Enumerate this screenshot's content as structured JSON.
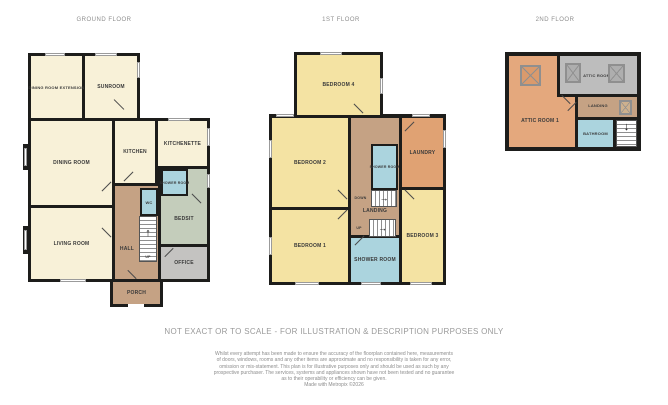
{
  "palette": {
    "wall": "#1d1d1b",
    "cream": "#f8f1d8",
    "yellow": "#f4e3a3",
    "tan": "#c5a284",
    "blue": "#abd4de",
    "sage": "#c4cdbb",
    "gray": "#c4c3c1",
    "orange": "#e0a273",
    "attic_orange": "#e4a87d",
    "attic_gray": "#bdbdbd",
    "label": "#3a3a3a",
    "title": "#8e8e8e"
  },
  "floors": {
    "ground": {
      "title": "GROUND FLOOR",
      "rooms": {
        "dining_room_extension": "DINING ROOM EXTENSION",
        "sunroom": "SUNROOM",
        "dining_room": "DINING ROOM",
        "kitchen": "KITCHEN",
        "kitchenette": "KITCHENETTE",
        "shower_room": "SHOWER ROOM",
        "wc": "WC",
        "bedsit": "BEDSIT",
        "living_room": "LIVING ROOM",
        "hall": "HALL",
        "office": "OFFICE",
        "porch": "PORCH"
      },
      "stair_up_label": "UP"
    },
    "first": {
      "title": "1ST FLOOR",
      "rooms": {
        "bedroom_4": "BEDROOM 4",
        "bedroom_2": "BEDROOM 2",
        "bedroom_1": "BEDROOM 1",
        "bedroom_3": "BEDROOM 3",
        "landing": "LANDING",
        "shower_room_middle": "SHOWER ROOM",
        "shower_room_bottom": "SHOWER ROOM",
        "laundry": "LAUNDRY"
      },
      "stair_down_label": "DOWN",
      "stair_up_label": "UP"
    },
    "second": {
      "title": "2ND FLOOR",
      "rooms": {
        "attic_room_1": "ATTIC ROOM 1",
        "attic_room_2": "ATTIC ROOM 2",
        "landing": "LANDING",
        "bathroom": "BATHROOM"
      }
    }
  },
  "icons": {
    "stairs_up_arrow": "↑",
    "stairs_right_arrow": "→",
    "stairs_down_arrow": "↓"
  },
  "footer": {
    "note": "NOT EXACT OR TO SCALE - FOR ILLUSTRATION & DESCRIPTION PURPOSES ONLY",
    "disclaimer_lines": [
      "Whilst every attempt has been made to ensure the accuracy of the floorplan contained here, measurements",
      "of doors, windows, rooms and any other items are approximate and no responsibility is taken for any error,",
      "omission or mis-statement. This plan is for illustrative purposes only and should be used as such by any",
      "prospective purchaser. The services, systems and appliances shown have not been tested and no guarantee",
      "as to their operability or efficiency can be given.",
      "Made with Metropix ©2026"
    ]
  }
}
